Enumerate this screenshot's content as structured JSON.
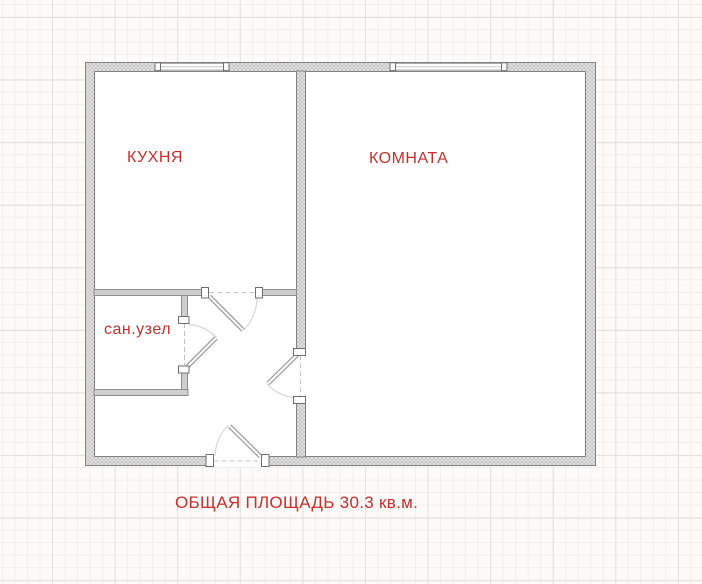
{
  "floorplan": {
    "rooms": [
      {
        "id": "kitchen",
        "label": "КУХНЯ"
      },
      {
        "id": "room",
        "label": "КОМНАТА"
      },
      {
        "id": "bathroom",
        "label": "сан.узел"
      }
    ],
    "caption": "ОБЩАЯ ПЛОЩАДЬ 30.3 кв.м.",
    "total_area_sqm": "30.3",
    "features": {
      "windows": [
        "kitchen-window",
        "room-window"
      ],
      "doors": [
        "kitchen-door",
        "bathroom-door",
        "room-door",
        "entrance-door"
      ]
    },
    "colors": {
      "label_text": "#c5302c",
      "wall_outline": "#828282",
      "wall_hatch_fill": "#e6e6e6",
      "interior_wall_fill": "#cecece",
      "floor": "#ffffff",
      "grid_major": "#e3e1de",
      "grid_minor": "#f1efec"
    }
  }
}
